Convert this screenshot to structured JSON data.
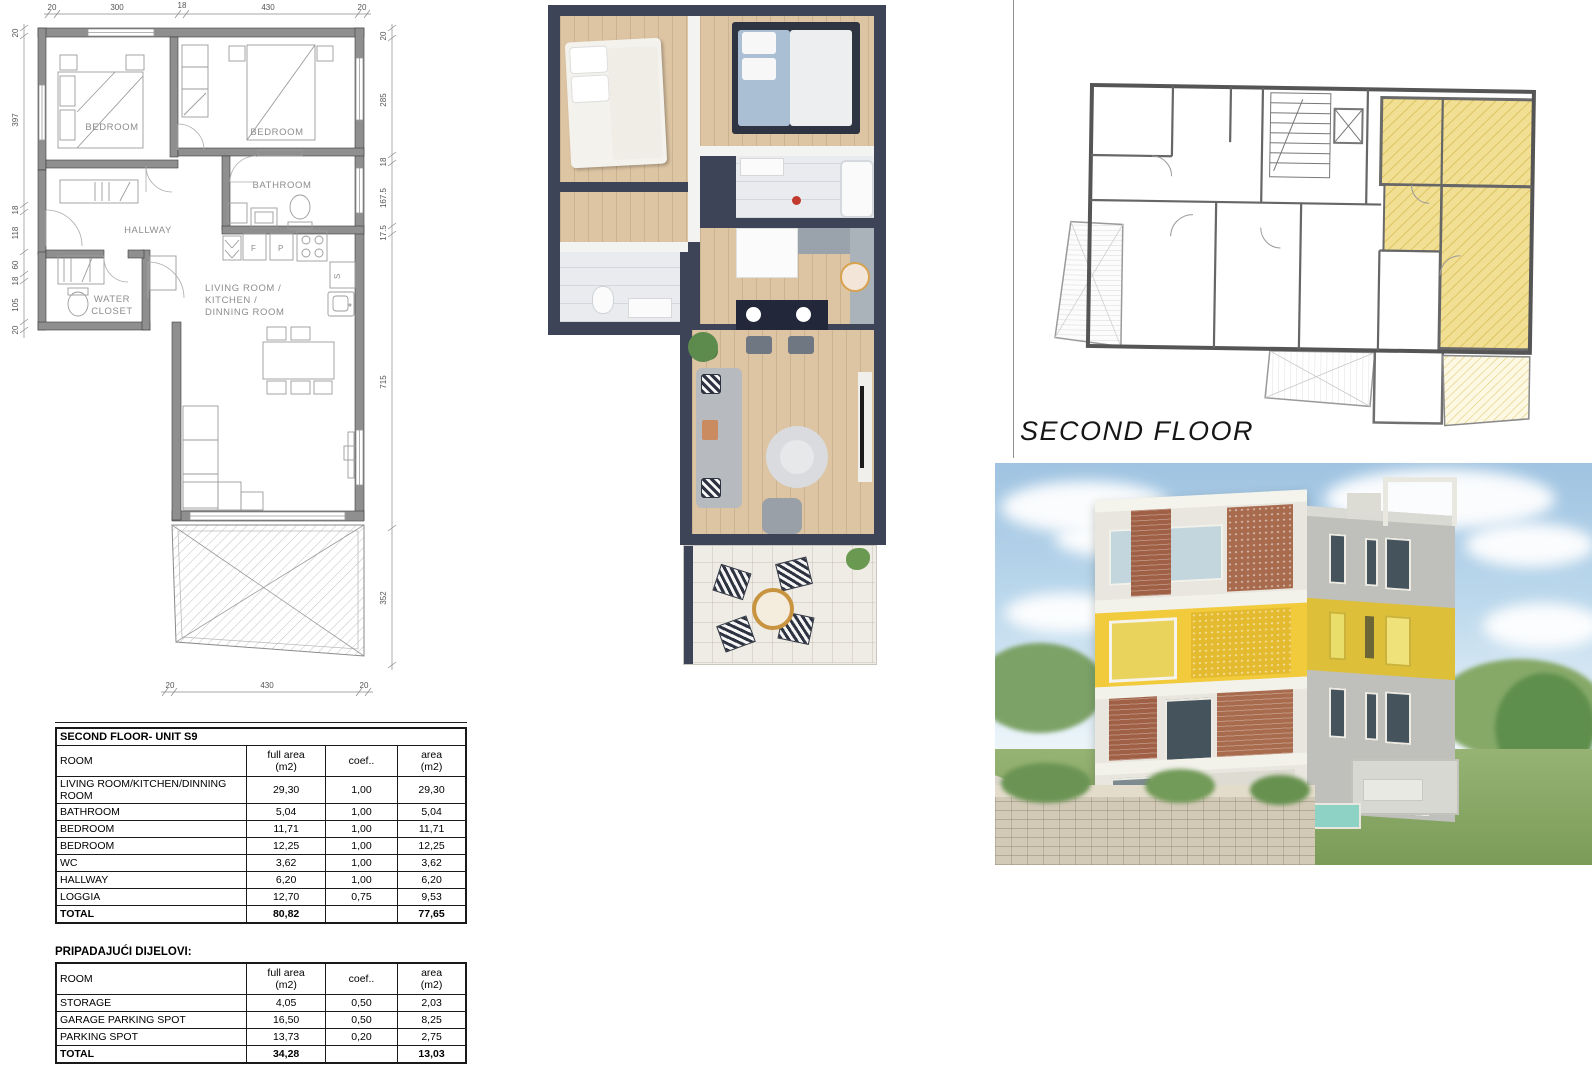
{
  "document": {
    "background": "#ffffff"
  },
  "tech_plan": {
    "labels": {
      "bedroom_left": "BEDROOM",
      "bedroom_right": "BEDROOM",
      "bathroom": "BATHROOM",
      "hallway": "HALLWAY",
      "water_closet_line1": "WATER",
      "water_closet_line2": "CLOSET",
      "living_line1": "LIVING ROOM /",
      "living_line2": "KITCHEN /",
      "living_line3": "DINNING ROOM",
      "kitchen_f": "F",
      "kitchen_p": "P",
      "kitchen_s": "S"
    },
    "dims": {
      "top": [
        "20",
        "300",
        "18",
        "430",
        "20"
      ],
      "bottom": [
        "20",
        "430",
        "20"
      ],
      "left": [
        "20",
        "397",
        "18",
        "118",
        "60",
        "18",
        "105",
        "20"
      ],
      "right": [
        "20",
        "285",
        "18",
        "167.5",
        "17.5",
        "715",
        "352"
      ]
    }
  },
  "overview": {
    "caption": "SECOND FLOOR",
    "highlight_color": "#f1df94"
  },
  "unit_table": {
    "title": "SECOND FLOOR-  UNIT S9",
    "headers": {
      "room": "ROOM",
      "full_area_line1": "full area",
      "full_area_line2": "(m2)",
      "coef": "coef..",
      "area_line1": "area",
      "area_line2": "(m2)"
    },
    "rows": [
      {
        "room": "LIVING ROOM/KITCHEN/DINNING ROOM",
        "full_area": "29,30",
        "coef": "1,00",
        "area": "29,30"
      },
      {
        "room": "BATHROOM",
        "full_area": "5,04",
        "coef": "1,00",
        "area": "5,04"
      },
      {
        "room": "BEDROOM",
        "full_area": "11,71",
        "coef": "1,00",
        "area": "11,71"
      },
      {
        "room": "BEDROOM",
        "full_area": "12,25",
        "coef": "1,00",
        "area": "12,25"
      },
      {
        "room": "WC",
        "full_area": "3,62",
        "coef": "1,00",
        "area": "3,62"
      },
      {
        "room": "HALLWAY",
        "full_area": "6,20",
        "coef": "1,00",
        "area": "6,20"
      },
      {
        "room": "LOGGIA",
        "full_area": "12,70",
        "coef": "0,75",
        "area": "9,53"
      }
    ],
    "total": {
      "label": "TOTAL",
      "full_area": "80,82",
      "area": "77,65"
    }
  },
  "annex_table": {
    "title": "PRIPADAJUĆI DIJELOVI:",
    "headers": {
      "room": "ROOM",
      "full_area_line1": "full area",
      "full_area_line2": "(m2)",
      "coef": "coef..",
      "area_line1": "area",
      "area_line2": "(m2)"
    },
    "rows": [
      {
        "room": "STORAGE",
        "full_area": "4,05",
        "coef": "0,50",
        "area": "2,03"
      },
      {
        "room": "GARAGE PARKING SPOT",
        "full_area": "16,50",
        "coef": "0,50",
        "area": "8,25"
      },
      {
        "room": "PARKING SPOT",
        "full_area": "13,73",
        "coef": "0,20",
        "area": "2,75"
      }
    ],
    "total": {
      "label": "TOTAL",
      "full_area": "34,28",
      "area": "13,03"
    }
  },
  "grand_total": {
    "label": "TOTAL",
    "value": "91,00",
    "unit": "m²"
  }
}
